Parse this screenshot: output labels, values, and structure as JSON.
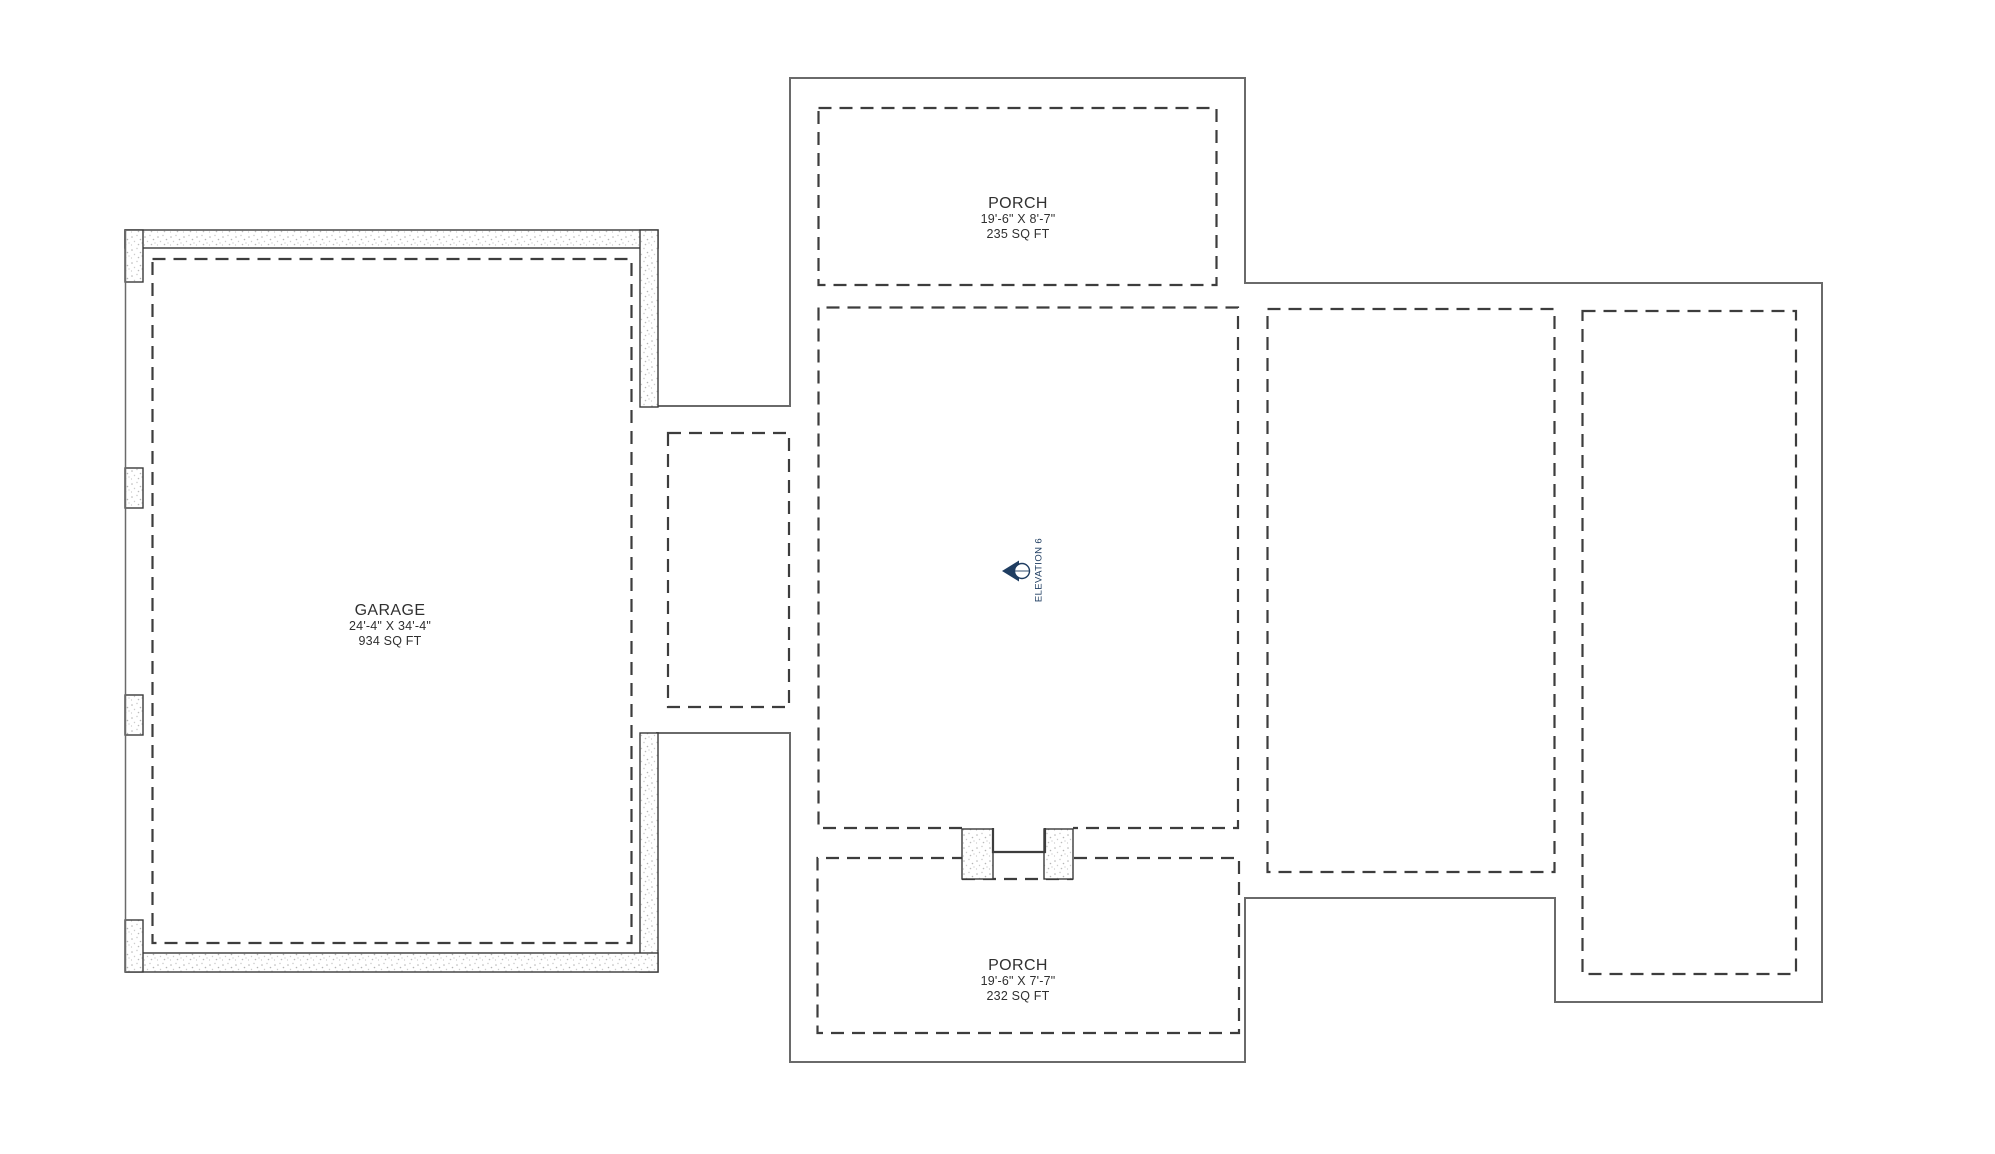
{
  "drawing": {
    "type": "foundation-floor-plan",
    "background": "#ffffff"
  },
  "rooms": {
    "garage": {
      "name": "GARAGE",
      "dims": "24'-4\" X 34'-4\"",
      "area": "934 SQ FT"
    },
    "top_porch": {
      "name": "PORCH",
      "dims": "19'-6\" X 8'-7\"",
      "area": "235 SQ FT"
    },
    "bottom_porch": {
      "name": "PORCH",
      "dims": "19'-6\" X 7'-7\"",
      "area": "232 SQ FT"
    }
  },
  "elevation_marker": {
    "label": "ELEVATION 6"
  },
  "colors": {
    "outline": "#6a6a6a",
    "wall_edge": "#3a3a3a",
    "dashed_line": "#3d3d3d",
    "stipple_dot": "#bcbcbc",
    "marker_navy": "#1f3d61",
    "text": "#303030"
  }
}
